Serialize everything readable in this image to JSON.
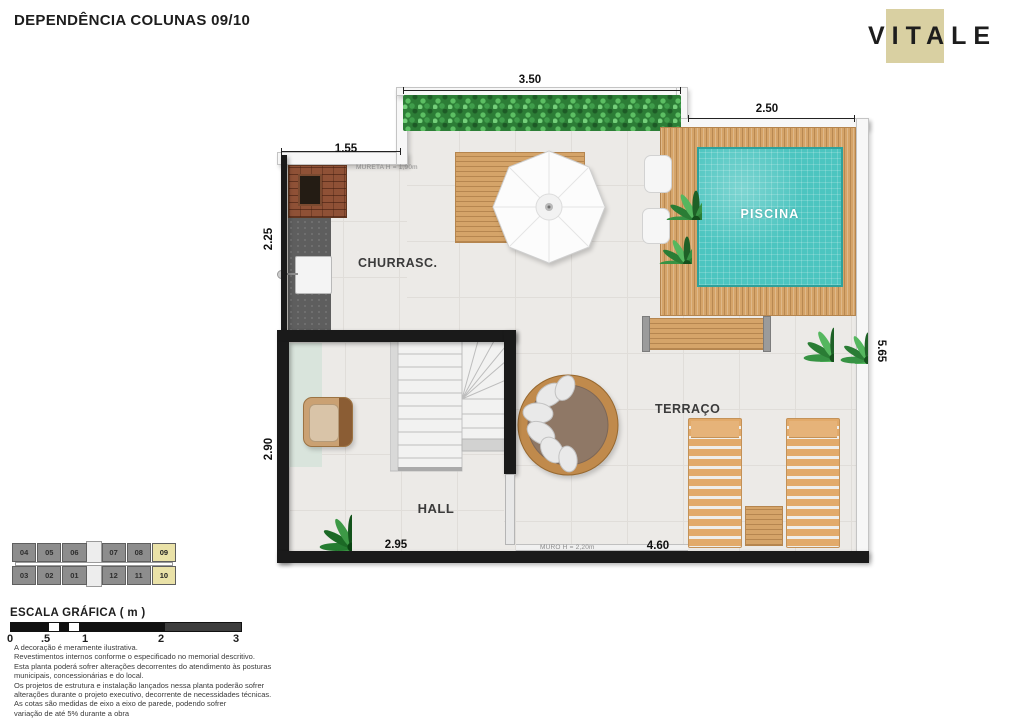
{
  "header": {
    "title": "DEPENDÊNCIA COLUNAS 09/10",
    "brand": "VITALE"
  },
  "plan": {
    "rooms": {
      "churrasco": "CHURRASC.",
      "piscina": "PISCINA",
      "terraco": "TERRAÇO",
      "hall": "HALL"
    },
    "dims": {
      "hedge_top": "3.50",
      "pool_top": "2.50",
      "left_top": "1.55",
      "left_upper": "2.25",
      "left_lower": "2.90",
      "right_side": "5.65",
      "hall_bottom": "2.95",
      "terrace_bottom": "4.60"
    },
    "notes": {
      "mureta": "MURETA H = 1,90m",
      "muro": "MURO H = 2,20m"
    }
  },
  "key_plan": {
    "top_row": [
      "04",
      "05",
      "06",
      "07",
      "08",
      "09"
    ],
    "bottom_row": [
      "03",
      "02",
      "01",
      "12",
      "11",
      "10"
    ],
    "highlighted": [
      "09",
      "10"
    ]
  },
  "scale_bar": {
    "title": "ESCALA GRÁFICA ( m )",
    "ticks": [
      "0",
      ".5",
      "1",
      "2",
      "3"
    ]
  },
  "disclaimer": {
    "lines": [
      "A decoração é meramente ilustrativa.",
      "Revestimentos internos conforme o especificado no memorial descritivo.",
      "Esta planta poderá sofrer alterações decorrentes do atendimento às posturas",
      "municipais, concessionárias e do local.",
      "Os projetos de estrutura e instalação lançados nessa planta poderão sofrer",
      "alterações durante o projeto executivo, decorrente de necessidades técnicas.",
      "As cotas são medidas de eixo a eixo de parede, podendo sofrer",
      "variação de até 5% durante a obra"
    ]
  },
  "colors": {
    "brand_beige": "#d9d0a2",
    "pool_water": "#4cc5c0",
    "deck_wood": "#d5a469",
    "hedge_green": "#2c7d36",
    "wall_black": "#1a1a1a",
    "floor_tile": "#eceae7",
    "keyplan_gray": "#8d8d8d",
    "keyplan_highlight": "#eae2a8"
  }
}
